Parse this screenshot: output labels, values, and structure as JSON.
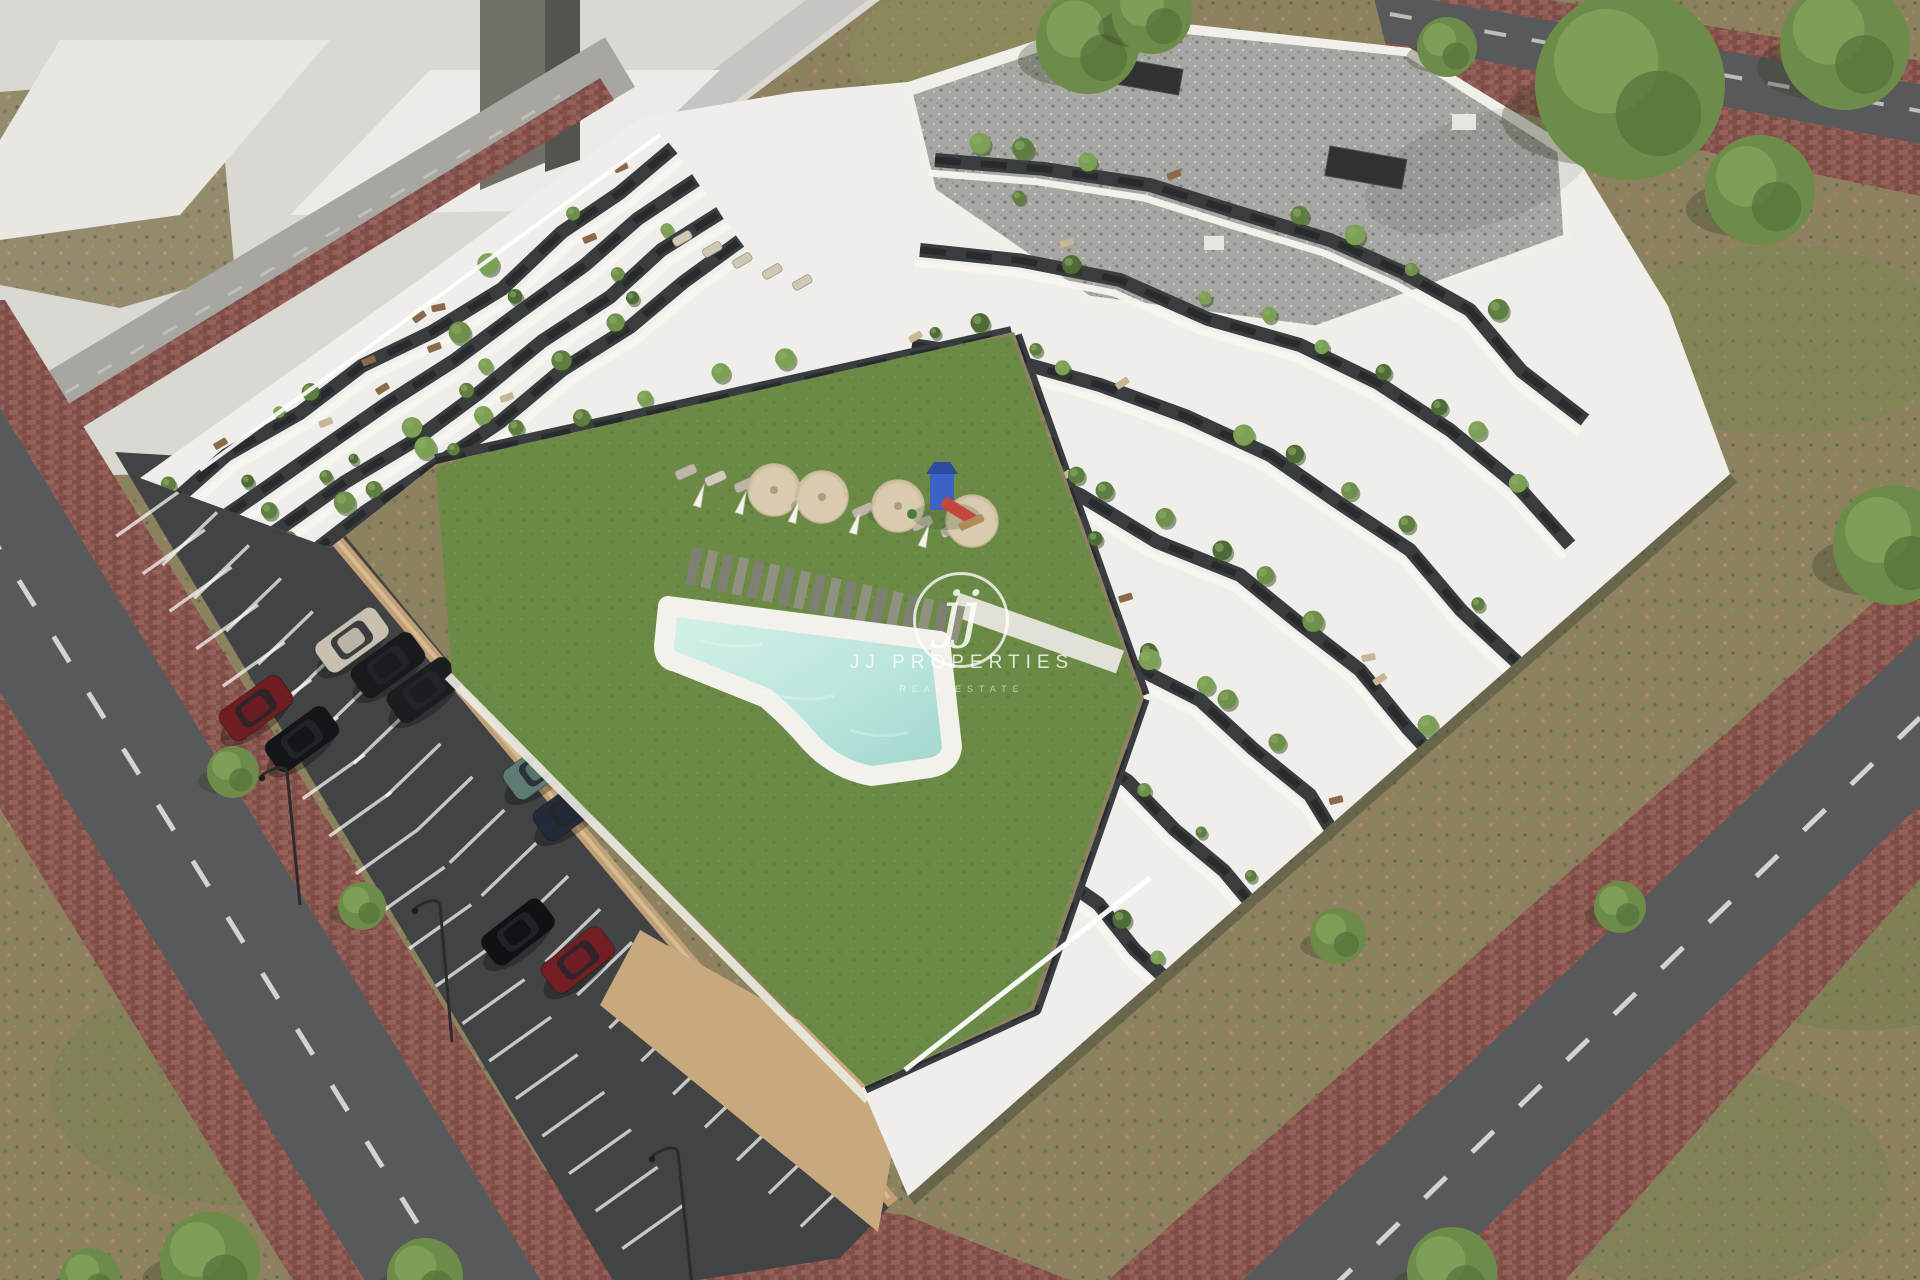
{
  "image": {
    "kind": "3d-architectural-aerial-render",
    "subject": "modern white terraced apartment complex with courtyard lawn, freeform pool, playground, parking lot and surrounding streets"
  },
  "watermark": {
    "monogram": "jj",
    "brand": "JJ PROPERTIES",
    "tagline": "REAL ESTATE"
  },
  "colors": {
    "scrub_ground": "#8d8160",
    "lawn": "#6b8a45",
    "lawn_dark": "#5d7a3b",
    "pool_water_light": "#cfeee7",
    "pool_water_deep": "#9fd6cc",
    "pool_deck": "#f3f1eb",
    "deck_plank": "#8b8c7e",
    "road_asphalt": "#58595a",
    "parking_asphalt": "#424344",
    "road_marking": "#e9e9e7",
    "sidewalk_brick": "#8d574f",
    "curb_tan": "#c2a077",
    "base_wall_tan": "#c8a87d",
    "building_white": "#f0eeea",
    "facade_dark": "#3a3d40",
    "window_dark": "#26282a",
    "roof_gravel": "#a6a7a3",
    "massing_gray": "#dad8d3",
    "massing_face": "#c6c5c1",
    "massing_dark_face": "#716f68",
    "umbrella": "#d8cbae",
    "playground_blue": "#3c63c4",
    "playground_red": "#c2473f",
    "tree_green": "#6d8c49"
  },
  "scene": {
    "building": {
      "style": "white wavy terraced balconies with dark recessed walls and planted terraces",
      "roof": "flat gravel roof with dark vents",
      "floors_visible": 7
    },
    "courtyard": {
      "lawn": true,
      "swimming_pool": 1,
      "pool_shape": "freeform",
      "sun_umbrellas": 4,
      "folded_umbrellas": 5,
      "sun_loungers": 10,
      "wood_deck_path": true,
      "playground": 1
    },
    "parking": {
      "marked_stalls": true,
      "cars": [
        {
          "x": 352,
          "y": 640,
          "angle": -36,
          "hex": "#c8c1b1",
          "color": "silver"
        },
        {
          "x": 388,
          "y": 665,
          "angle": -36,
          "hex": "#191a1e",
          "color": "black"
        },
        {
          "x": 424,
          "y": 690,
          "angle": -36,
          "hex": "#1c1d21",
          "color": "black"
        },
        {
          "x": 256,
          "y": 708,
          "angle": -36,
          "hex": "#701d22",
          "color": "dark-red"
        },
        {
          "x": 302,
          "y": 739,
          "angle": -36,
          "hex": "#141519",
          "color": "black"
        },
        {
          "x": 540,
          "y": 767,
          "angle": -36,
          "hex": "#5d7a73",
          "color": "teal"
        },
        {
          "x": 570,
          "y": 808,
          "angle": -36,
          "hex": "#242a3a",
          "color": "dark-blue"
        },
        {
          "x": 518,
          "y": 932,
          "angle": -38,
          "hex": "#101114",
          "color": "black"
        },
        {
          "x": 578,
          "y": 960,
          "angle": -38,
          "hex": "#731e23",
          "color": "dark-red"
        }
      ]
    },
    "streets": {
      "surface": "asphalt with white dashed lane markings",
      "sidewalks": "red clay brick pavers",
      "street_trees": 5,
      "street_lamps": 3,
      "surrounding_ground": "dry scrubland with patchy grass"
    }
  }
}
